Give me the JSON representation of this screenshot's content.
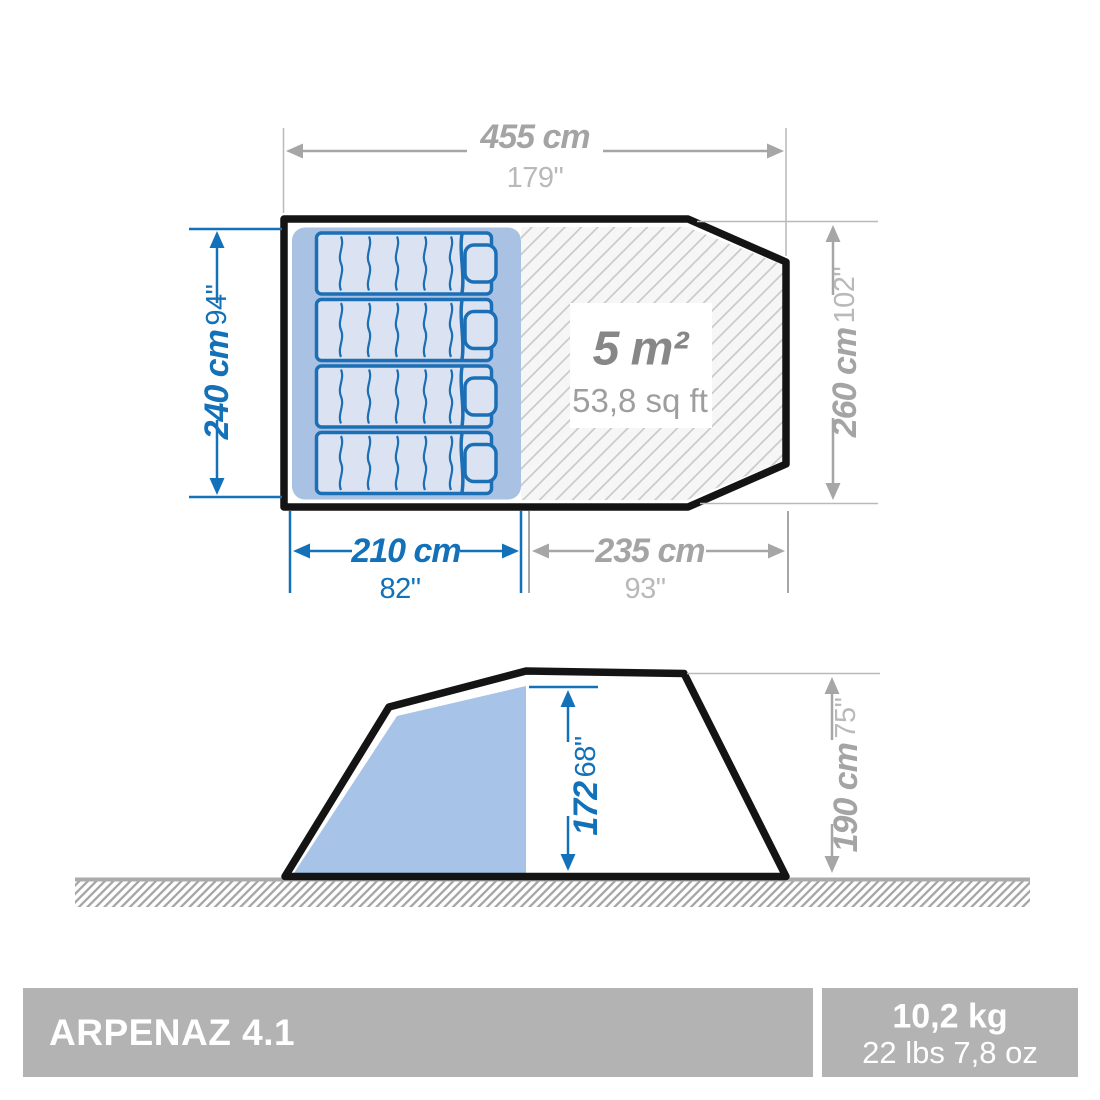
{
  "product": {
    "model": "ARPENAZ 4.1",
    "weight_kg": "10,2 kg",
    "weight_lbs": "22 lbs 7,8 oz"
  },
  "top_view": {
    "total_width": {
      "metric": "455 cm",
      "imperial": "179\""
    },
    "left_depth": {
      "metric": "240 cm",
      "imperial": "94\""
    },
    "right_depth": {
      "metric": "260 cm",
      "imperial": "102\""
    },
    "sleeping_width": {
      "metric": "210 cm",
      "imperial": "82\""
    },
    "living_width": {
      "metric": "235 cm",
      "imperial": "93\""
    },
    "living_area": {
      "metric": "5 m²",
      "imperial": "53,8 sq ft"
    }
  },
  "side_view": {
    "interior_height": {
      "metric": "172",
      "imperial": "68\""
    },
    "exterior_height": {
      "metric": "190 cm",
      "imperial": "75\""
    }
  },
  "colors": {
    "dimension_blue": "#1371b9",
    "dimension_gray": "#a6a6a6",
    "outline_black": "#141414",
    "sleeping_area_blue": "#a9c2e3",
    "mattress_fill": "#dbe3f2",
    "side_fill_blue": "#a7c3e8",
    "footer_bar_gray": "#b3b3b3",
    "hatch_line_gray": "#cbcbcb"
  }
}
